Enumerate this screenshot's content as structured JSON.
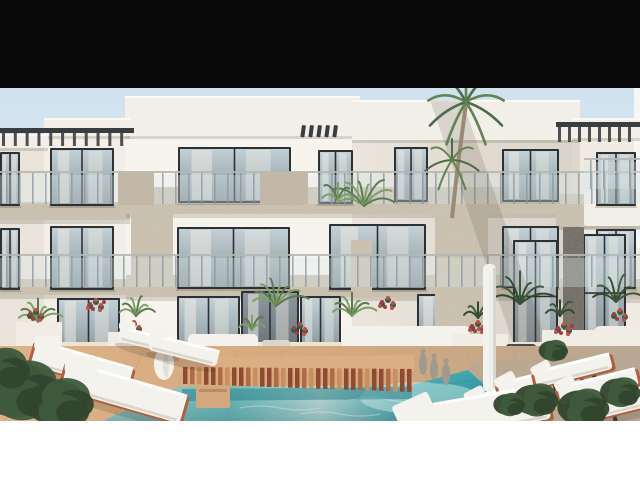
{
  "meta": {
    "description": "Architectural 3D rendering of a modern white three-storey apartment complex with glass balconies, stone-clad piers, palm trees, terrace plants, white sun loungers, a wooden slatted bridge and a turquoise swimming pool; black letterbox bar at top, white bar at bottom",
    "width": 640,
    "height": 480
  },
  "frame": {
    "top_bar_height": 88,
    "image_bottom": 421,
    "top_bar_color": "#0a0a0a",
    "bottom_bar_color": "#ffffff"
  },
  "colors": {
    "skyTop": "#cfe2ee",
    "skyMid": "#e7eef2",
    "skyLow": "#f3efe7",
    "wallFar": "#e9e3d9",
    "wallLeftWing": "#f3efe8",
    "wallMainLeft": "#f7f4ee",
    "wallMainCenter": "#ebe5dc",
    "wallFarRight": "#efeae2",
    "edgeStrip": "#f6f6f4",
    "roof": "#f2efe9",
    "roofShadow": "rgba(95,85,65,0.20)",
    "stoneLight": "#cfc5b4",
    "stonePanel": "#c6bbaa",
    "stoneDark": "#6a665e",
    "frameDark": "#2e3134",
    "glassTop": "#c3d1d6",
    "glassBottom": "#87959c",
    "curtain": "#ece9e3",
    "railGlass": "#d9e7e8",
    "railPost": "#8f999d",
    "railTop": "#b4b8b4",
    "pergola": "#3b3e41",
    "finColor": "#3a3d40",
    "deckWarm": "#ddb287",
    "deckMid": "#d3a87e",
    "deckGray": "#b7a893",
    "plankLine": "#a87c54",
    "slatA": "#8f4a2f",
    "slatB": "#b06a44",
    "slatC": "#c98f5f",
    "walkway": "#dcae83",
    "poolPale": "#c2e3da",
    "poolLight": "#7ccaca",
    "poolBright": "#d8efe8",
    "poolMid": "#55b4ba",
    "poolDeep": "#2f9aa3",
    "bridgeShadow": "#1f7b85",
    "loungerWhite": "#f4f2ed",
    "loungerShade": "#d9d5cc",
    "railTerracotta": "#b06040",
    "legDark": "#3b3733",
    "greenDark": "#3e5a3c",
    "greenMid": "#5c7a50",
    "greenLight": "#7fa065",
    "palmDark": "#4c6b46",
    "palmMid": "#618452",
    "trunk": "#9a8a74",
    "flowerRed": "#c14c4c",
    "planterWhite": "#f1ede5",
    "potDark": "#4a4a48",
    "potLight": "#dcd6ca",
    "statueGray": "#a09a8e",
    "terrace": "#ece3d4",
    "shadow": "rgba(80,70,55,0.16)"
  },
  "scene": {
    "blocks": [
      {
        "x": 0,
        "y": 134,
        "w": 48,
        "h": 287,
        "c": "wallFar"
      },
      {
        "x": 44,
        "y": 118,
        "w": 86,
        "h": 303,
        "c": "wallLeftWing"
      },
      {
        "x": 125,
        "y": 96,
        "w": 235,
        "h": 325,
        "c": "wallMainLeft"
      },
      {
        "x": 352,
        "y": 100,
        "w": 228,
        "h": 321,
        "c": "wallMainCenter"
      },
      {
        "x": 572,
        "y": 118,
        "w": 68,
        "h": 303,
        "c": "wallFarRight"
      },
      {
        "x": 634,
        "y": 88,
        "w": 6,
        "h": 160,
        "c": "edgeStrip"
      }
    ],
    "roofbands": [
      {
        "x": 125,
        "y": 96,
        "w": 235,
        "h": 40
      },
      {
        "x": 352,
        "y": 100,
        "w": 228,
        "h": 40
      },
      {
        "x": 44,
        "y": 118,
        "w": 86,
        "h": 18
      },
      {
        "x": 0,
        "y": 134,
        "w": 48,
        "h": 14
      },
      {
        "x": 572,
        "y": 118,
        "w": 68,
        "h": 20
      }
    ],
    "bands": [
      {
        "x": 0,
        "y": 202,
        "w": 130,
        "h": 18
      },
      {
        "x": 126,
        "y": 187,
        "w": 432,
        "h": 27
      },
      {
        "x": 556,
        "y": 194,
        "w": 84,
        "h": 32
      },
      {
        "x": 0,
        "y": 279,
        "w": 130,
        "h": 16
      },
      {
        "x": 126,
        "y": 275,
        "w": 432,
        "h": 22
      },
      {
        "x": 556,
        "y": 279,
        "w": 84,
        "h": 20
      }
    ],
    "balconySlabs": [
      {
        "x": 584,
        "y": 192,
        "w": 56,
        "h": 34
      }
    ],
    "windows": [
      {
        "x": 0,
        "y": 152,
        "w": 20,
        "h": 54,
        "t": "w"
      },
      {
        "x": 50,
        "y": 148,
        "w": 64,
        "h": 58,
        "t": "w"
      },
      {
        "x": 178,
        "y": 147,
        "w": 113,
        "h": 56,
        "t": "w"
      },
      {
        "x": 318,
        "y": 150,
        "w": 35,
        "h": 54,
        "t": "w"
      },
      {
        "x": 394,
        "y": 147,
        "w": 34,
        "h": 55,
        "t": "w"
      },
      {
        "x": 502,
        "y": 149,
        "w": 57,
        "h": 53,
        "t": "w"
      },
      {
        "x": 596,
        "y": 152,
        "w": 40,
        "h": 54,
        "t": "w"
      },
      {
        "x": 0,
        "y": 228,
        "w": 20,
        "h": 62,
        "t": "w"
      },
      {
        "x": 50,
        "y": 226,
        "w": 64,
        "h": 64,
        "t": "w"
      },
      {
        "x": 177,
        "y": 227,
        "w": 113,
        "h": 62,
        "t": "w"
      },
      {
        "x": 329,
        "y": 224,
        "w": 97,
        "h": 66,
        "t": "w"
      },
      {
        "x": 502,
        "y": 226,
        "w": 57,
        "h": 62,
        "t": "w"
      },
      {
        "x": 596,
        "y": 229,
        "w": 40,
        "h": 60,
        "t": "w"
      },
      {
        "x": 57,
        "y": 298,
        "w": 63,
        "h": 59,
        "t": "w"
      },
      {
        "x": 177,
        "y": 296,
        "w": 63,
        "h": 60,
        "t": "w"
      },
      {
        "x": 300,
        "y": 296,
        "w": 41,
        "h": 57,
        "t": "w"
      },
      {
        "x": 417,
        "y": 294,
        "w": 53,
        "h": 56,
        "t": "w"
      },
      {
        "x": 513,
        "y": 240,
        "w": 45,
        "h": 107,
        "t": "tall"
      },
      {
        "x": 583,
        "y": 234,
        "w": 43,
        "h": 112,
        "t": "tall"
      },
      {
        "x": 241,
        "y": 291,
        "w": 58,
        "h": 63,
        "t": "door"
      }
    ],
    "rails": [
      {
        "x": 0,
        "y": 171,
        "w": 640,
        "h": 35
      },
      {
        "x": 0,
        "y": 254,
        "w": 640,
        "h": 35
      },
      {
        "x": 584,
        "y": 158,
        "w": 56,
        "h": 33
      }
    ],
    "stonePanels": [
      {
        "x": 118,
        "y": 172,
        "w": 36,
        "h": 33
      },
      {
        "x": 260,
        "y": 172,
        "w": 48,
        "h": 33
      }
    ],
    "piers": [
      {
        "x": 131,
        "y": 214,
        "w": 42,
        "h": 64,
        "dark": false
      },
      {
        "x": 351,
        "y": 240,
        "w": 21,
        "h": 58,
        "dark": false
      },
      {
        "x": 435,
        "y": 211,
        "w": 53,
        "h": 124,
        "dark": false
      },
      {
        "x": 563,
        "y": 227,
        "w": 21,
        "h": 121,
        "dark": true
      }
    ],
    "fins": {
      "x0": 302,
      "y": 125,
      "n": 5,
      "dx": 8,
      "w": 4,
      "h": 12
    },
    "pergolas": [
      {
        "x": 0,
        "y": 128,
        "w": 134,
        "h": 20,
        "n": 11
      },
      {
        "x": 556,
        "y": 122,
        "w": 84,
        "h": 22,
        "n": 8
      }
    ],
    "palm": {
      "trunk": [
        [
          452,
          218
        ],
        [
          457,
          170
        ],
        [
          461,
          140
        ],
        [
          466,
          104
        ]
      ],
      "clusters": [
        {
          "cx": 466,
          "cy": 102,
          "n": 9,
          "len": 52
        },
        {
          "cx": 452,
          "cy": 160,
          "n": 7,
          "len": 36
        }
      ]
    },
    "balconyPlants": [
      {
        "cx": 364,
        "cy": 206,
        "n": 8,
        "len": 40
      },
      {
        "cx": 338,
        "cy": 200,
        "n": 5,
        "len": 24
      }
    ],
    "fans": [
      {
        "cx": 38,
        "cy": 322,
        "n": 7,
        "len": 30,
        "dark": false
      },
      {
        "cx": 136,
        "cy": 316,
        "n": 6,
        "len": 26,
        "dark": false
      },
      {
        "cx": 276,
        "cy": 306,
        "n": 8,
        "len": 36,
        "dark": false
      },
      {
        "cx": 352,
        "cy": 316,
        "n": 7,
        "len": 30,
        "dark": false
      },
      {
        "cx": 252,
        "cy": 330,
        "n": 5,
        "len": 20,
        "dark": false
      },
      {
        "cx": 520,
        "cy": 304,
        "n": 7,
        "len": 42,
        "dark": true
      },
      {
        "cx": 616,
        "cy": 302,
        "n": 6,
        "len": 36,
        "dark": true
      },
      {
        "cx": 478,
        "cy": 318,
        "n": 5,
        "len": 22,
        "dark": true
      },
      {
        "cx": 560,
        "cy": 316,
        "n": 5,
        "len": 22,
        "dark": true
      }
    ],
    "planters": [
      {
        "x": 16,
        "y": 322,
        "w": 46,
        "h": 36
      },
      {
        "x": 108,
        "y": 332,
        "w": 50,
        "h": 30
      },
      {
        "x": 452,
        "y": 334,
        "w": 56,
        "h": 30
      },
      {
        "x": 542,
        "y": 330,
        "w": 52,
        "h": 30
      }
    ],
    "pots": [
      {
        "x": 262,
        "y": 340,
        "w": 28,
        "h": 34,
        "c": "potLight"
      },
      {
        "x": 506,
        "y": 344,
        "w": 30,
        "h": 26,
        "c": "potDark"
      }
    ],
    "sofas": [
      {
        "x": 188,
        "y": 334,
        "w": 70,
        "h": 34
      },
      {
        "x": 342,
        "y": 326,
        "w": 128,
        "h": 46
      }
    ],
    "stepBlock": {
      "x": 594,
      "y": 326,
      "w": 46,
      "h": 46
    },
    "doorStep": {
      "x": 236,
      "y": 352,
      "w": 66,
      "h": 12
    },
    "flowers": [
      {
        "x": 96,
        "y": 306,
        "n": 7
      },
      {
        "x": 134,
        "y": 328,
        "n": 6
      },
      {
        "x": 300,
        "y": 330,
        "n": 5
      },
      {
        "x": 388,
        "y": 304,
        "n": 6
      },
      {
        "x": 478,
        "y": 328,
        "n": 8
      },
      {
        "x": 564,
        "y": 330,
        "n": 7
      },
      {
        "x": 620,
        "y": 316,
        "n": 5
      },
      {
        "x": 36,
        "y": 316,
        "n": 5
      }
    ],
    "pool": {
      "pts": [
        [
          102,
          421
        ],
        [
          178,
          387
        ],
        [
          412,
          385
        ],
        [
          468,
          370
        ],
        [
          524,
          421
        ]
      ]
    },
    "bridge": {
      "x0": 183,
      "x1": 411,
      "ytop": 367,
      "hL": 17,
      "hR": 23,
      "walkway": [
        [
          150,
          358
        ],
        [
          414,
          355
        ],
        [
          414,
          371
        ],
        [
          150,
          374
        ]
      ],
      "shadow": [
        [
          182,
          389
        ],
        [
          412,
          387
        ],
        [
          412,
          399
        ],
        [
          182,
          401
        ]
      ]
    },
    "statues": [
      {
        "x": 419,
        "y": 352
      },
      {
        "x": 430,
        "y": 357
      },
      {
        "x": 442,
        "y": 362
      }
    ],
    "fountain": {
      "x": 483,
      "y": 264,
      "w": 13,
      "h": 128
    },
    "vase": {
      "x": 154,
      "y": 330,
      "w": 20,
      "h": 60
    },
    "stool": {
      "x": 196,
      "y": 386,
      "w": 34,
      "h": 22
    },
    "loungers": [
      {
        "cx": 150,
        "cy": 341,
        "len": 64,
        "wid": 15,
        "a": 14,
        "legs": false,
        "rail": false
      },
      {
        "cx": 184,
        "cy": 350,
        "len": 70,
        "wid": 17,
        "a": 14,
        "legs": false,
        "rail": false
      },
      {
        "cx": 82,
        "cy": 366,
        "len": 100,
        "wid": 26,
        "a": 16,
        "legs": false,
        "rail": true
      },
      {
        "cx": 124,
        "cy": 392,
        "len": 124,
        "wid": 30,
        "a": 16,
        "legs": false,
        "rail": true
      },
      {
        "cx": 508,
        "cy": 397,
        "len": 80,
        "wid": 20,
        "a": -14,
        "legs": true,
        "rail": true
      },
      {
        "cx": 539,
        "cy": 382,
        "len": 82,
        "wid": 19,
        "a": -14,
        "legs": true,
        "rail": true
      },
      {
        "cx": 573,
        "cy": 370,
        "len": 78,
        "wid": 17,
        "a": -14,
        "legs": true,
        "rail": true
      },
      {
        "cx": 598,
        "cy": 386,
        "len": 80,
        "wid": 19,
        "a": -14,
        "legs": true,
        "rail": true
      },
      {
        "cx": 630,
        "cy": 400,
        "len": 70,
        "wid": 21,
        "a": -14,
        "legs": true,
        "rail": true
      },
      {
        "cx": 474,
        "cy": 414,
        "len": 150,
        "wid": 36,
        "a": -10,
        "legs": false,
        "rail": true
      }
    ],
    "bushes": [
      {
        "cx": 28,
        "cy": 394,
        "r": 36
      },
      {
        "cx": 66,
        "cy": 406,
        "r": 30
      },
      {
        "cx": 6,
        "cy": 372,
        "r": 26
      },
      {
        "cx": 540,
        "cy": 402,
        "r": 20
      },
      {
        "cx": 588,
        "cy": 410,
        "r": 23
      },
      {
        "cx": 624,
        "cy": 394,
        "r": 18
      },
      {
        "cx": 556,
        "cy": 352,
        "r": 13
      },
      {
        "cx": 512,
        "cy": 406,
        "r": 14
      }
    ],
    "facadeShadow": [
      [
        430,
        100
      ],
      [
        462,
        100
      ],
      [
        548,
        346
      ],
      [
        514,
        346
      ]
    ]
  }
}
